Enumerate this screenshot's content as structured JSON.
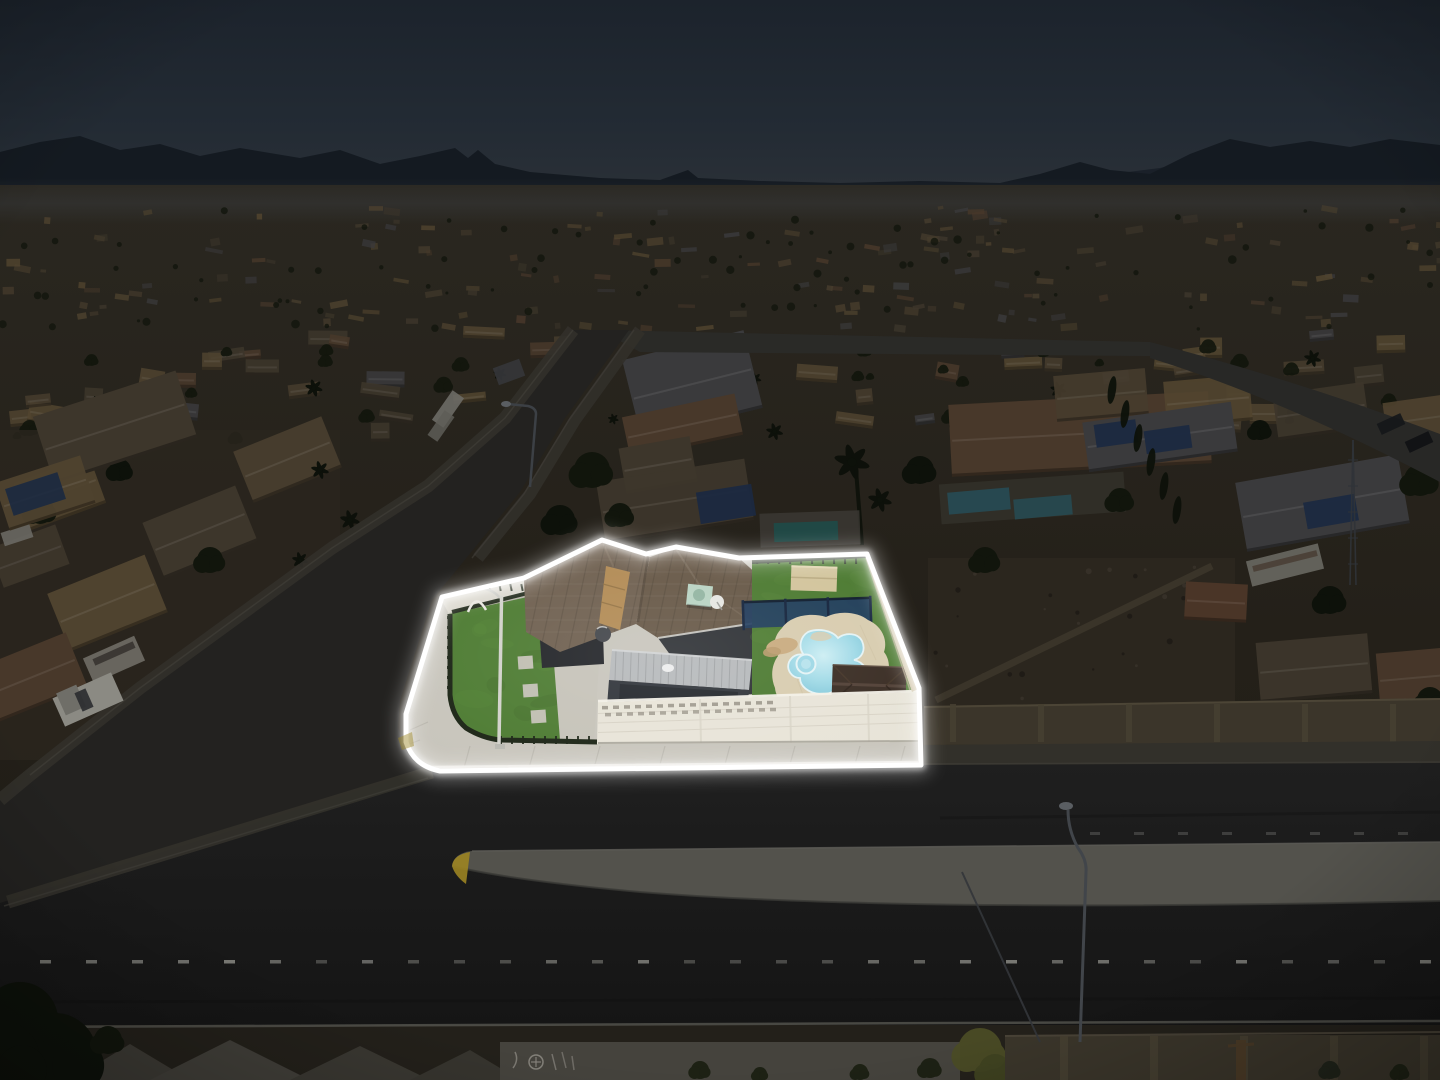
{
  "scene": {
    "type": "aerial-drone-photo",
    "subject": "corner-lot single-story home with pool highlighted by glowing white property outline; surrounding neighborhood artificially darkened",
    "palette": {
      "sky_top": "#1c232c",
      "sky_mid": "#232b34",
      "sky_low": "#2d3238",
      "mountain": "#141a21",
      "mountain_far": "#1a2029",
      "haze": "#3c4046",
      "ground_far": "#2a2720",
      "ground_mid": "#242019",
      "ground_near": "#1f1c16",
      "road_dim": "#232220",
      "curb_dim": "#3e3c36",
      "sidewalk_dim": "#32302a",
      "arterial_top": "#1f1f1f",
      "arterial_bottom": "#151515",
      "median": "#53524c",
      "median_edge": "#5e5d57",
      "median_nose_yellow": "#9c8422",
      "lane_dot": "#b8b8b0",
      "lane_dot_dim": "#8f908a",
      "south_curb": "#55554f",
      "south_roof": "#3c3a34",
      "south_wall": "#45433d",
      "south_wall_tan": "#3a352a",
      "graffiti": "#8a8780",
      "tree_dark": "#11150c",
      "tree_darker": "#0d110a",
      "olive_tree": "#4b4c25",
      "bush": "#1d2114",
      "roof_dim_1": "#463c2d",
      "roof_dim_2": "#4f432f",
      "roof_dim_3": "#3d362b",
      "roof_dim_4": "#52452f",
      "roof_dim_5": "#3a3a3c",
      "roof_dim_6": "#48382a",
      "solar_panel": "#1b2940",
      "pool_dim": "#1f4a47",
      "pool_tarp": "#274a52",
      "dirt_dim": "#2b261e",
      "wall_dim_tan": "#3b352a",
      "pilaster_dim": "#463f31",
      "vehicle_white_dim": "#6d6c66",
      "vehicle_gray_dim": "#55544e",
      "pole_dim": "#41454a",
      "lamp_dim": "#5a5e62",
      "cell_tower": "#2f3338",
      "power_pole": "#4a3a26",
      "outline_white": "#ffffff",
      "lot_sidewalk": "#c8c5bc",
      "lot_curb": "#e9e6df",
      "lot_joint": "#b2afa6",
      "turf_front": "#4e7c33",
      "turf_back": "#4c7a31",
      "turf_light": "#5d8c3d",
      "turf_dark": "#3f6628",
      "iron_fence": "#1d2617",
      "back_wall": "#d9d6cc",
      "trellis_white": "#e8e6df",
      "lamp_bright": "#d2d2cb",
      "walkway": "#c6c3b9",
      "roof_brown": "#6f6050",
      "roof_brown_2": "#675847",
      "roof_shadow": "#564a3b",
      "ridge_light": "#7d6e5d",
      "plywood": "#b28b55",
      "porch_dark": "#232529",
      "gable_dark": "#2e3135",
      "fascia": "#c9c8c2",
      "ac_unit": "#b9d3c3",
      "ac_vent": "#93b5a2",
      "dish_white": "#e6e6e2",
      "dish_dark": "#43464b",
      "patio_cover": "#b6b9bb",
      "patio_rib": "#9da0a2",
      "patio_under": "#30343a",
      "patio_tag": "#eceded",
      "wall_white": "#e8e4d8",
      "wall_course": "#d7d2c5",
      "wall_deco": "#8e897e",
      "wall_cap": "#f4f1e8",
      "wall_base_shadow": "#a8a59a",
      "deck": "#d8ccaf",
      "deck_joint": "#c2b697",
      "water_edge": "#79c2d6",
      "water_mid": "#9fd9e6",
      "water_center": "#cdeef3",
      "waterline": "#e4f3f5",
      "spa": "#9ed8e6",
      "spa_inner": "#b7e2ec",
      "mesh_fence_navy": "#1e3a5c",
      "mesh_rail": "#0e1a2c",
      "shed_bright": "#d2c49c",
      "shed_edge": "#b6a87f",
      "gazebo_roof": "#3a2d24",
      "gazebo_ridge": "#55443a",
      "gazebo_post": "#a97c4e",
      "gazebo_shadow": "#173012",
      "rock": "#c9ab7f"
    },
    "objects": [
      "sky",
      "mountains",
      "darkened-neighborhood",
      "diagonal-street",
      "distant-cross-street",
      "right-street",
      "arterial-road",
      "median-island",
      "lane-markings",
      "property-highlight",
      "property-outline",
      "front-lawn",
      "iron-fence",
      "street-lamp-bright",
      "house-roof",
      "patio-cover",
      "ac-unit",
      "satellite-dishes",
      "backyard-lawn",
      "pool-mesh-fence",
      "shed",
      "swimming-pool",
      "spa",
      "gazebo",
      "perimeter-wall",
      "sidewalk",
      "street-light-right",
      "street-light-left",
      "pickup-truck",
      "rv-trailer",
      "parked-cars",
      "south-side-roofs",
      "graffiti-wall",
      "olive-tree",
      "power-pole",
      "cell-tower"
    ]
  }
}
